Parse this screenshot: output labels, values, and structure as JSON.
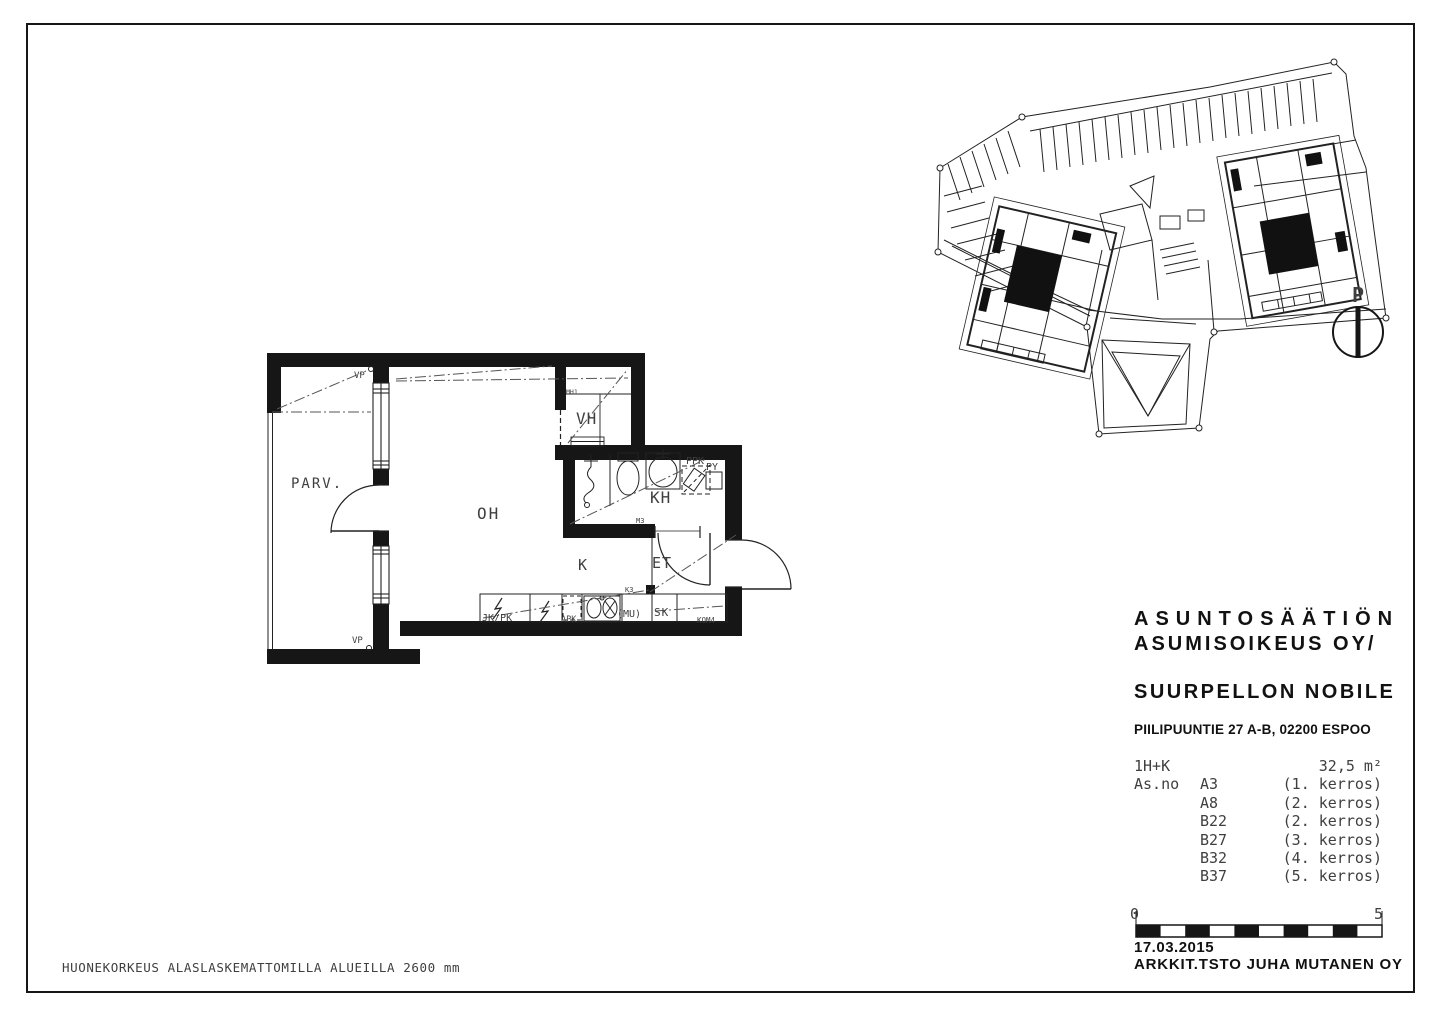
{
  "colors": {
    "paper": "#ffffff",
    "ink": "#161616",
    "cad_text": "#3f3f3f"
  },
  "footer_note": "HUONEKORKEUS ALASLASKEMATTOMILLA ALUEILLA 2600 mm",
  "title_block": {
    "owner_line1": "ASUNTOSÄÄTIÖN",
    "owner_line2": "ASUMISOIKEUS OY/",
    "project": "SUURPELLON NOBILE",
    "address": "PIILIPUUNTIE 27 A-B, 02200 ESPOO",
    "unit_type": "1H+K",
    "unit_area": "32,5 m²",
    "as_no_label": "As.no",
    "apartments": [
      {
        "no": "A3",
        "floor": "(1. kerros)"
      },
      {
        "no": "A8",
        "floor": "(2. kerros)"
      },
      {
        "no": "B22",
        "floor": "(2. kerros)"
      },
      {
        "no": "B27",
        "floor": "(3. kerros)"
      },
      {
        "no": "B32",
        "floor": "(4. kerros)"
      },
      {
        "no": "B37",
        "floor": "(5. kerros)"
      }
    ],
    "date": "17.03.2015",
    "architect": "ARKKIT.TSTO JUHA MUTANEN OY",
    "scale_start": "0",
    "scale_end": "5"
  },
  "floor_plan": {
    "rooms": {
      "balcony": "PARV.",
      "living_room": "OH",
      "closet": "VH",
      "bathroom": "KH",
      "kitchen": "K",
      "entry": "ET"
    },
    "marks": {
      "vp_top": "VP",
      "vp_bottom": "VP",
      "mh1": "MH1",
      "m3": "M3",
      "k3": "K3",
      "jk_pk": "JK/PK",
      "apk": "APK",
      "mu": "(MU)",
      "sk": "SK",
      "kom4": "KOM4",
      "ppk": "PPK",
      "py": "PY"
    }
  },
  "site_plan": {
    "north_label": "P"
  }
}
